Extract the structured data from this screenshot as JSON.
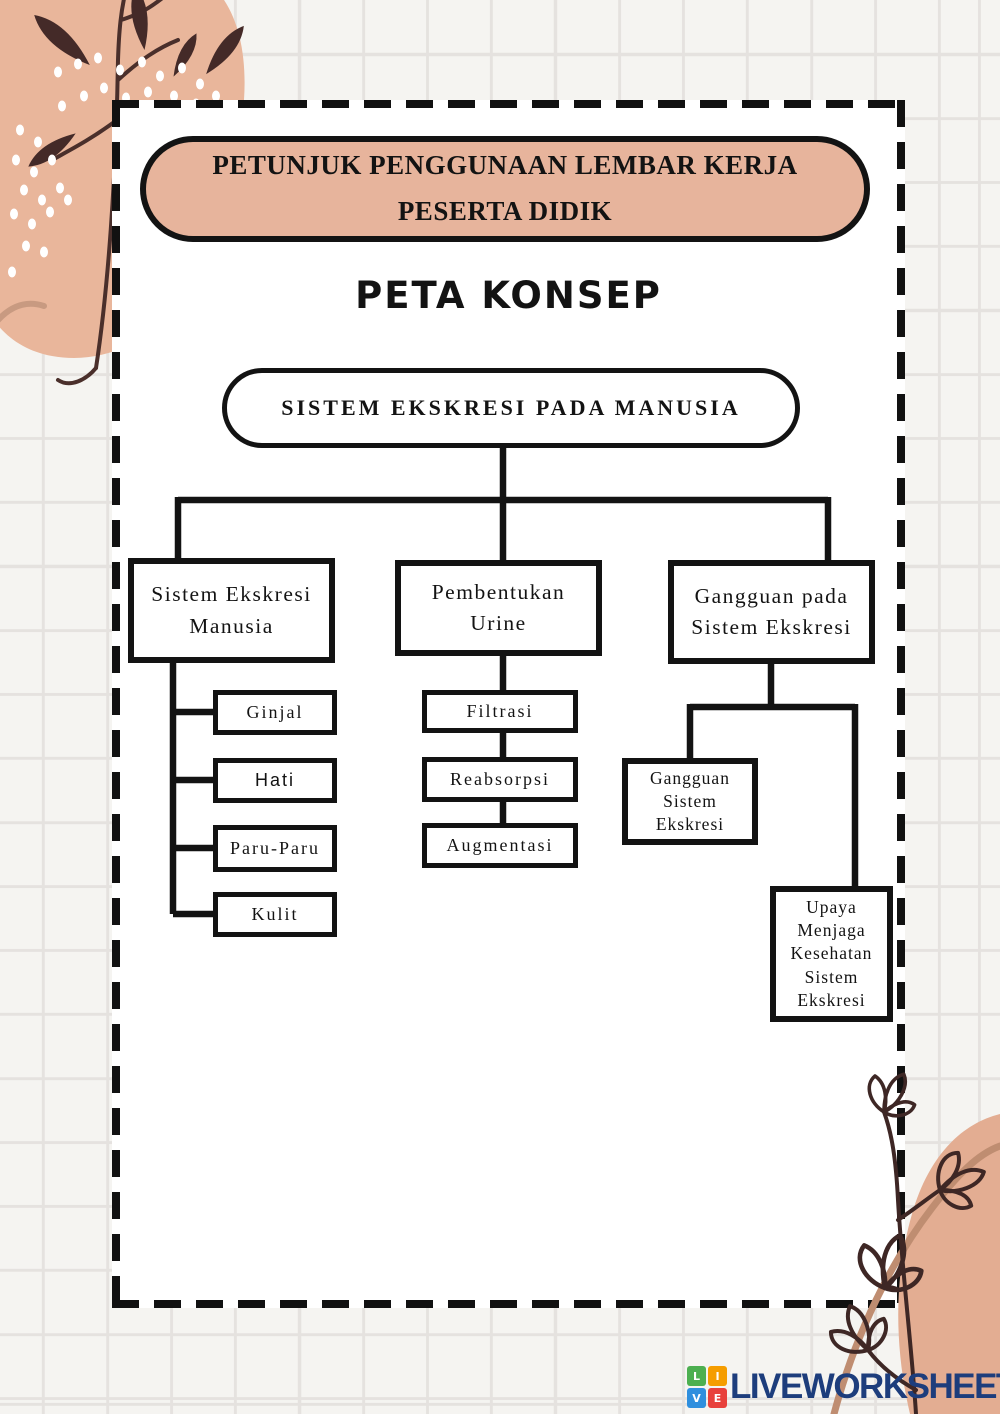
{
  "header": {
    "banner": "PETUNJUK PENGGUNAAN LEMBAR KERJA PESERTA DIDIK",
    "heading": "PETA KONSEP"
  },
  "map": {
    "root": "SISTEM EKSKRESI PADA MANUSIA",
    "branches": [
      {
        "label": "Sistem Ekskresi Manusia",
        "children": [
          "Ginjal",
          "Hati",
          "Paru-Paru",
          "Kulit"
        ]
      },
      {
        "label": "Pembentukan Urine",
        "children": [
          "Filtrasi",
          "Reabsorpsi",
          "Augmentasi"
        ]
      },
      {
        "label": "Gangguan pada Sistem Ekskresi",
        "children": [
          "Gangguan Sistem Ekskresi",
          "Upaya Menjaga Kesehatan Sistem Ekskresi"
        ]
      }
    ]
  },
  "footer": {
    "logo_text": "LIVEWORKSHEETS",
    "tiles": [
      {
        "letter": "L",
        "color": "#4caf50"
      },
      {
        "letter": "I",
        "color": "#f59d00"
      },
      {
        "letter": "V",
        "color": "#2f8fde"
      },
      {
        "letter": "E",
        "color": "#e8413c"
      }
    ]
  },
  "colors": {
    "banner_fill": "#e7b49c",
    "blob_peach": "#e9b69b",
    "leaf_brown": "#442a28",
    "line_black": "#131313",
    "logo_navy": "#1d3d7c"
  }
}
